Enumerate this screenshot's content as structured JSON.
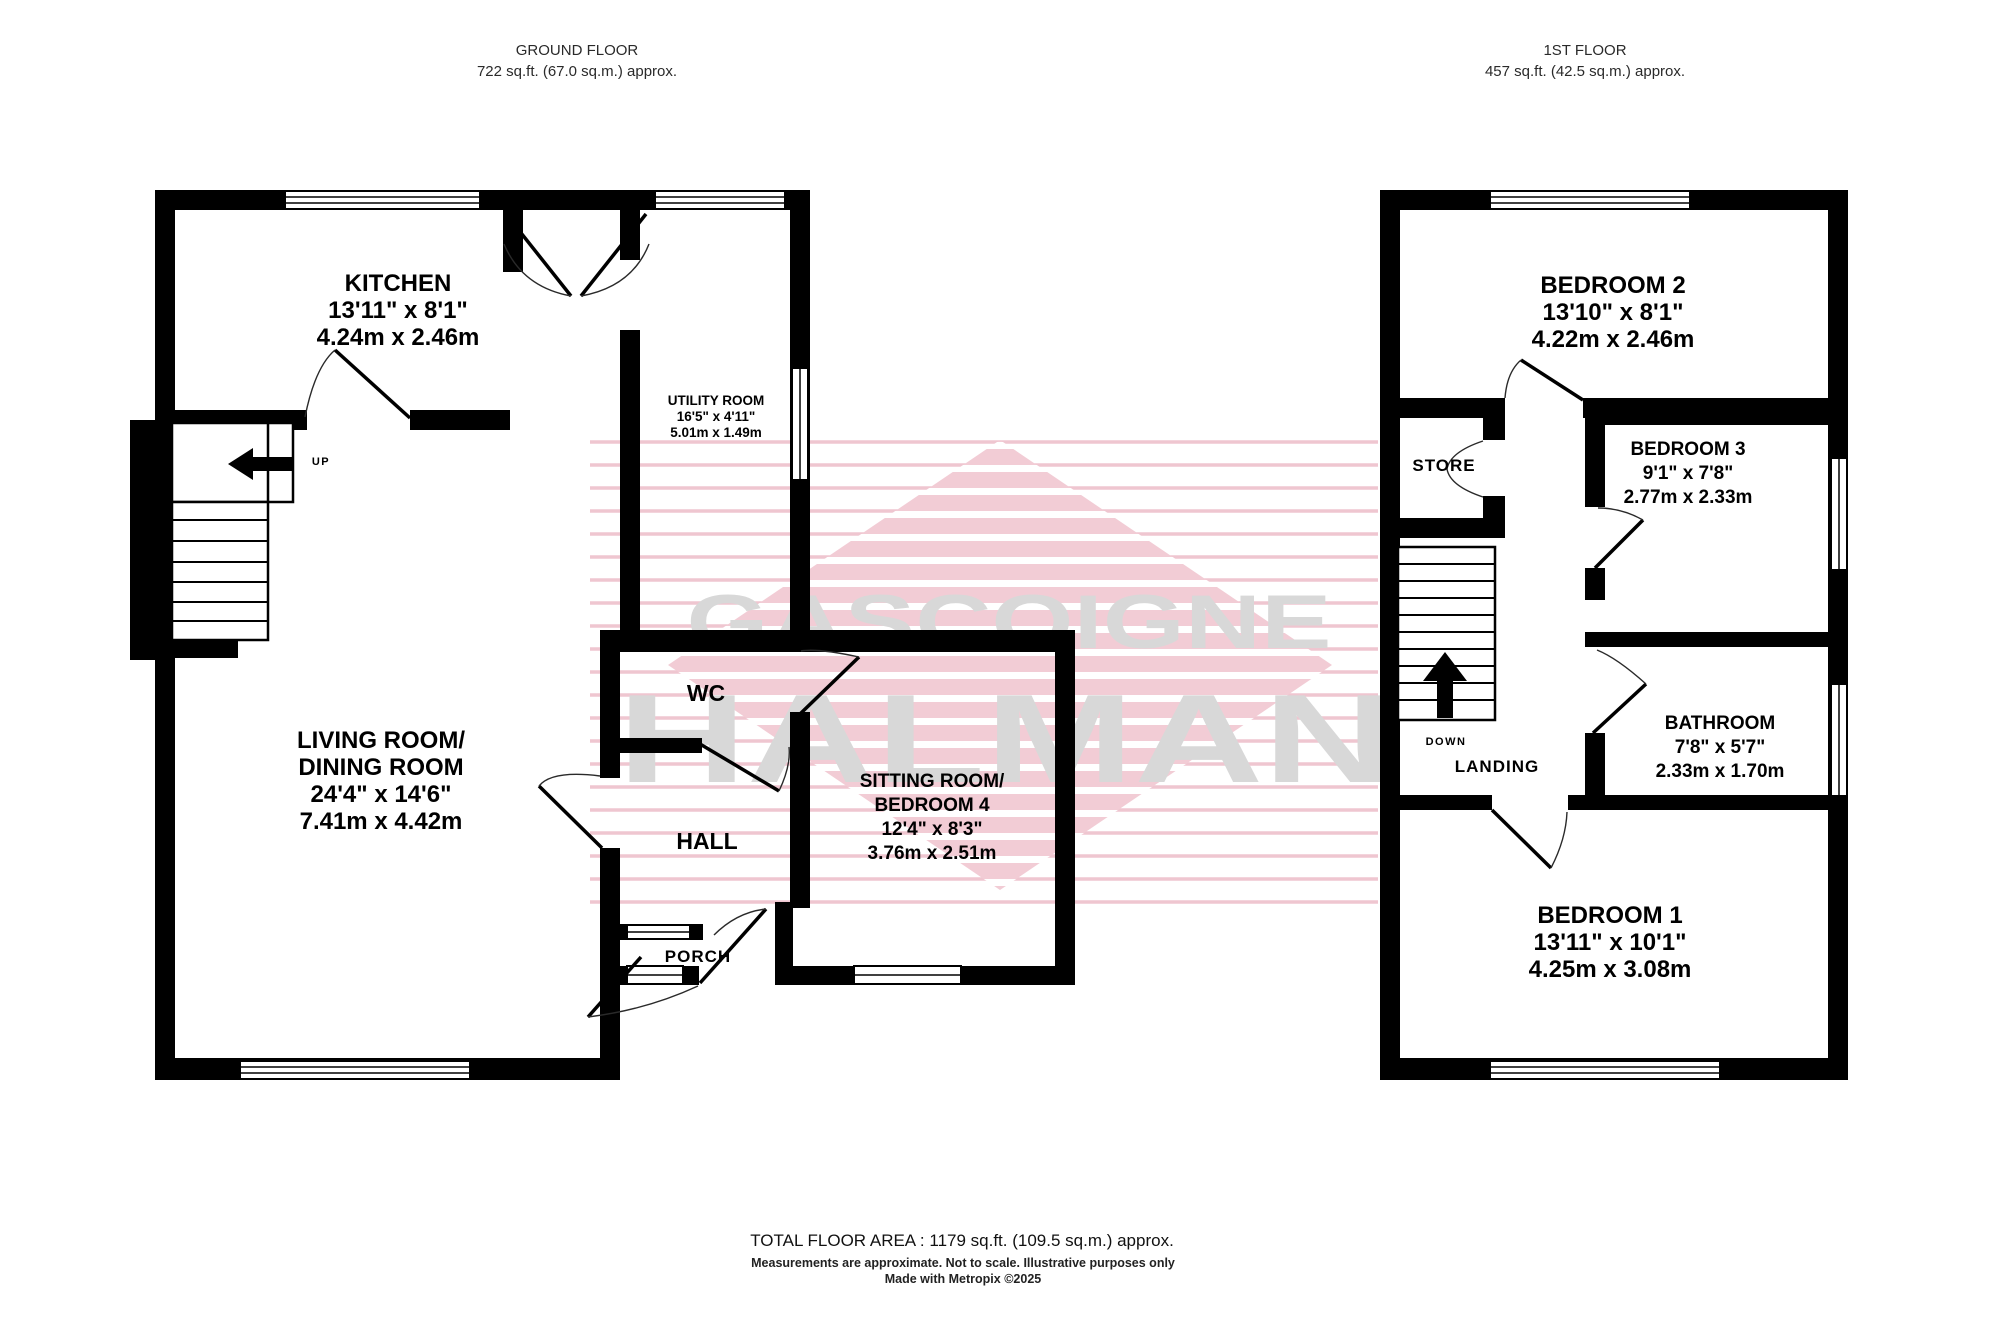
{
  "ground_floor": {
    "header_title": "GROUND FLOOR",
    "header_area": "722 sq.ft. (67.0 sq.m.) approx.",
    "rooms": {
      "kitchen": {
        "name": "KITCHEN",
        "imperial": "13'11\"  x 8'1\"",
        "metric": "4.24m  x 2.46m"
      },
      "utility": {
        "name": "UTILITY ROOM",
        "imperial": "16'5\"  x 4'11\"",
        "metric": "5.01m  x 1.49m"
      },
      "living": {
        "name1": "LIVING ROOM/",
        "name2": "DINING ROOM",
        "imperial": "24'4\"  x 14'6\"",
        "metric": "7.41m  x 4.42m"
      },
      "sitting": {
        "name1": "SITTING ROOM/",
        "name2": "BEDROOM 4",
        "imperial": "12'4\"  x 8'3\"",
        "metric": "3.76m  x 2.51m"
      },
      "wc": "WC",
      "hall": "HALL",
      "porch": "PORCH"
    },
    "stairs_label": "UP"
  },
  "first_floor": {
    "header_title": "1ST FLOOR",
    "header_area": "457 sq.ft. (42.5 sq.m.) approx.",
    "rooms": {
      "bedroom2": {
        "name": "BEDROOM 2",
        "imperial": "13'10\"  x 8'1\"",
        "metric": "4.22m  x 2.46m"
      },
      "bedroom3": {
        "name": "BEDROOM 3",
        "imperial": "9'1\"  x 7'8\"",
        "metric": "2.77m  x 2.33m"
      },
      "bathroom": {
        "name": "BATHROOM",
        "imperial": "7'8\"  x 5'7\"",
        "metric": "2.33m  x 1.70m"
      },
      "bedroom1": {
        "name": "BEDROOM 1",
        "imperial": "13'11\"  x 10'1\"",
        "metric": "4.25m  x 3.08m"
      },
      "store": "STORE",
      "landing": "LANDING"
    },
    "stairs_label": "DOWN"
  },
  "watermark": {
    "line1": "GASCOIGNE",
    "line2": "HALMAN",
    "pink_stripe": "#f2ccd5",
    "pink_line": "#efc6d0",
    "text_gray": "#d8d8d8"
  },
  "footer": {
    "total": "TOTAL FLOOR AREA : 1179 sq.ft. (109.5 sq.m.) approx.",
    "disclaimer": "Measurements are approximate.  Not to scale.  Illustrative purposes only",
    "credit": "Made with Metropix ©2025"
  }
}
